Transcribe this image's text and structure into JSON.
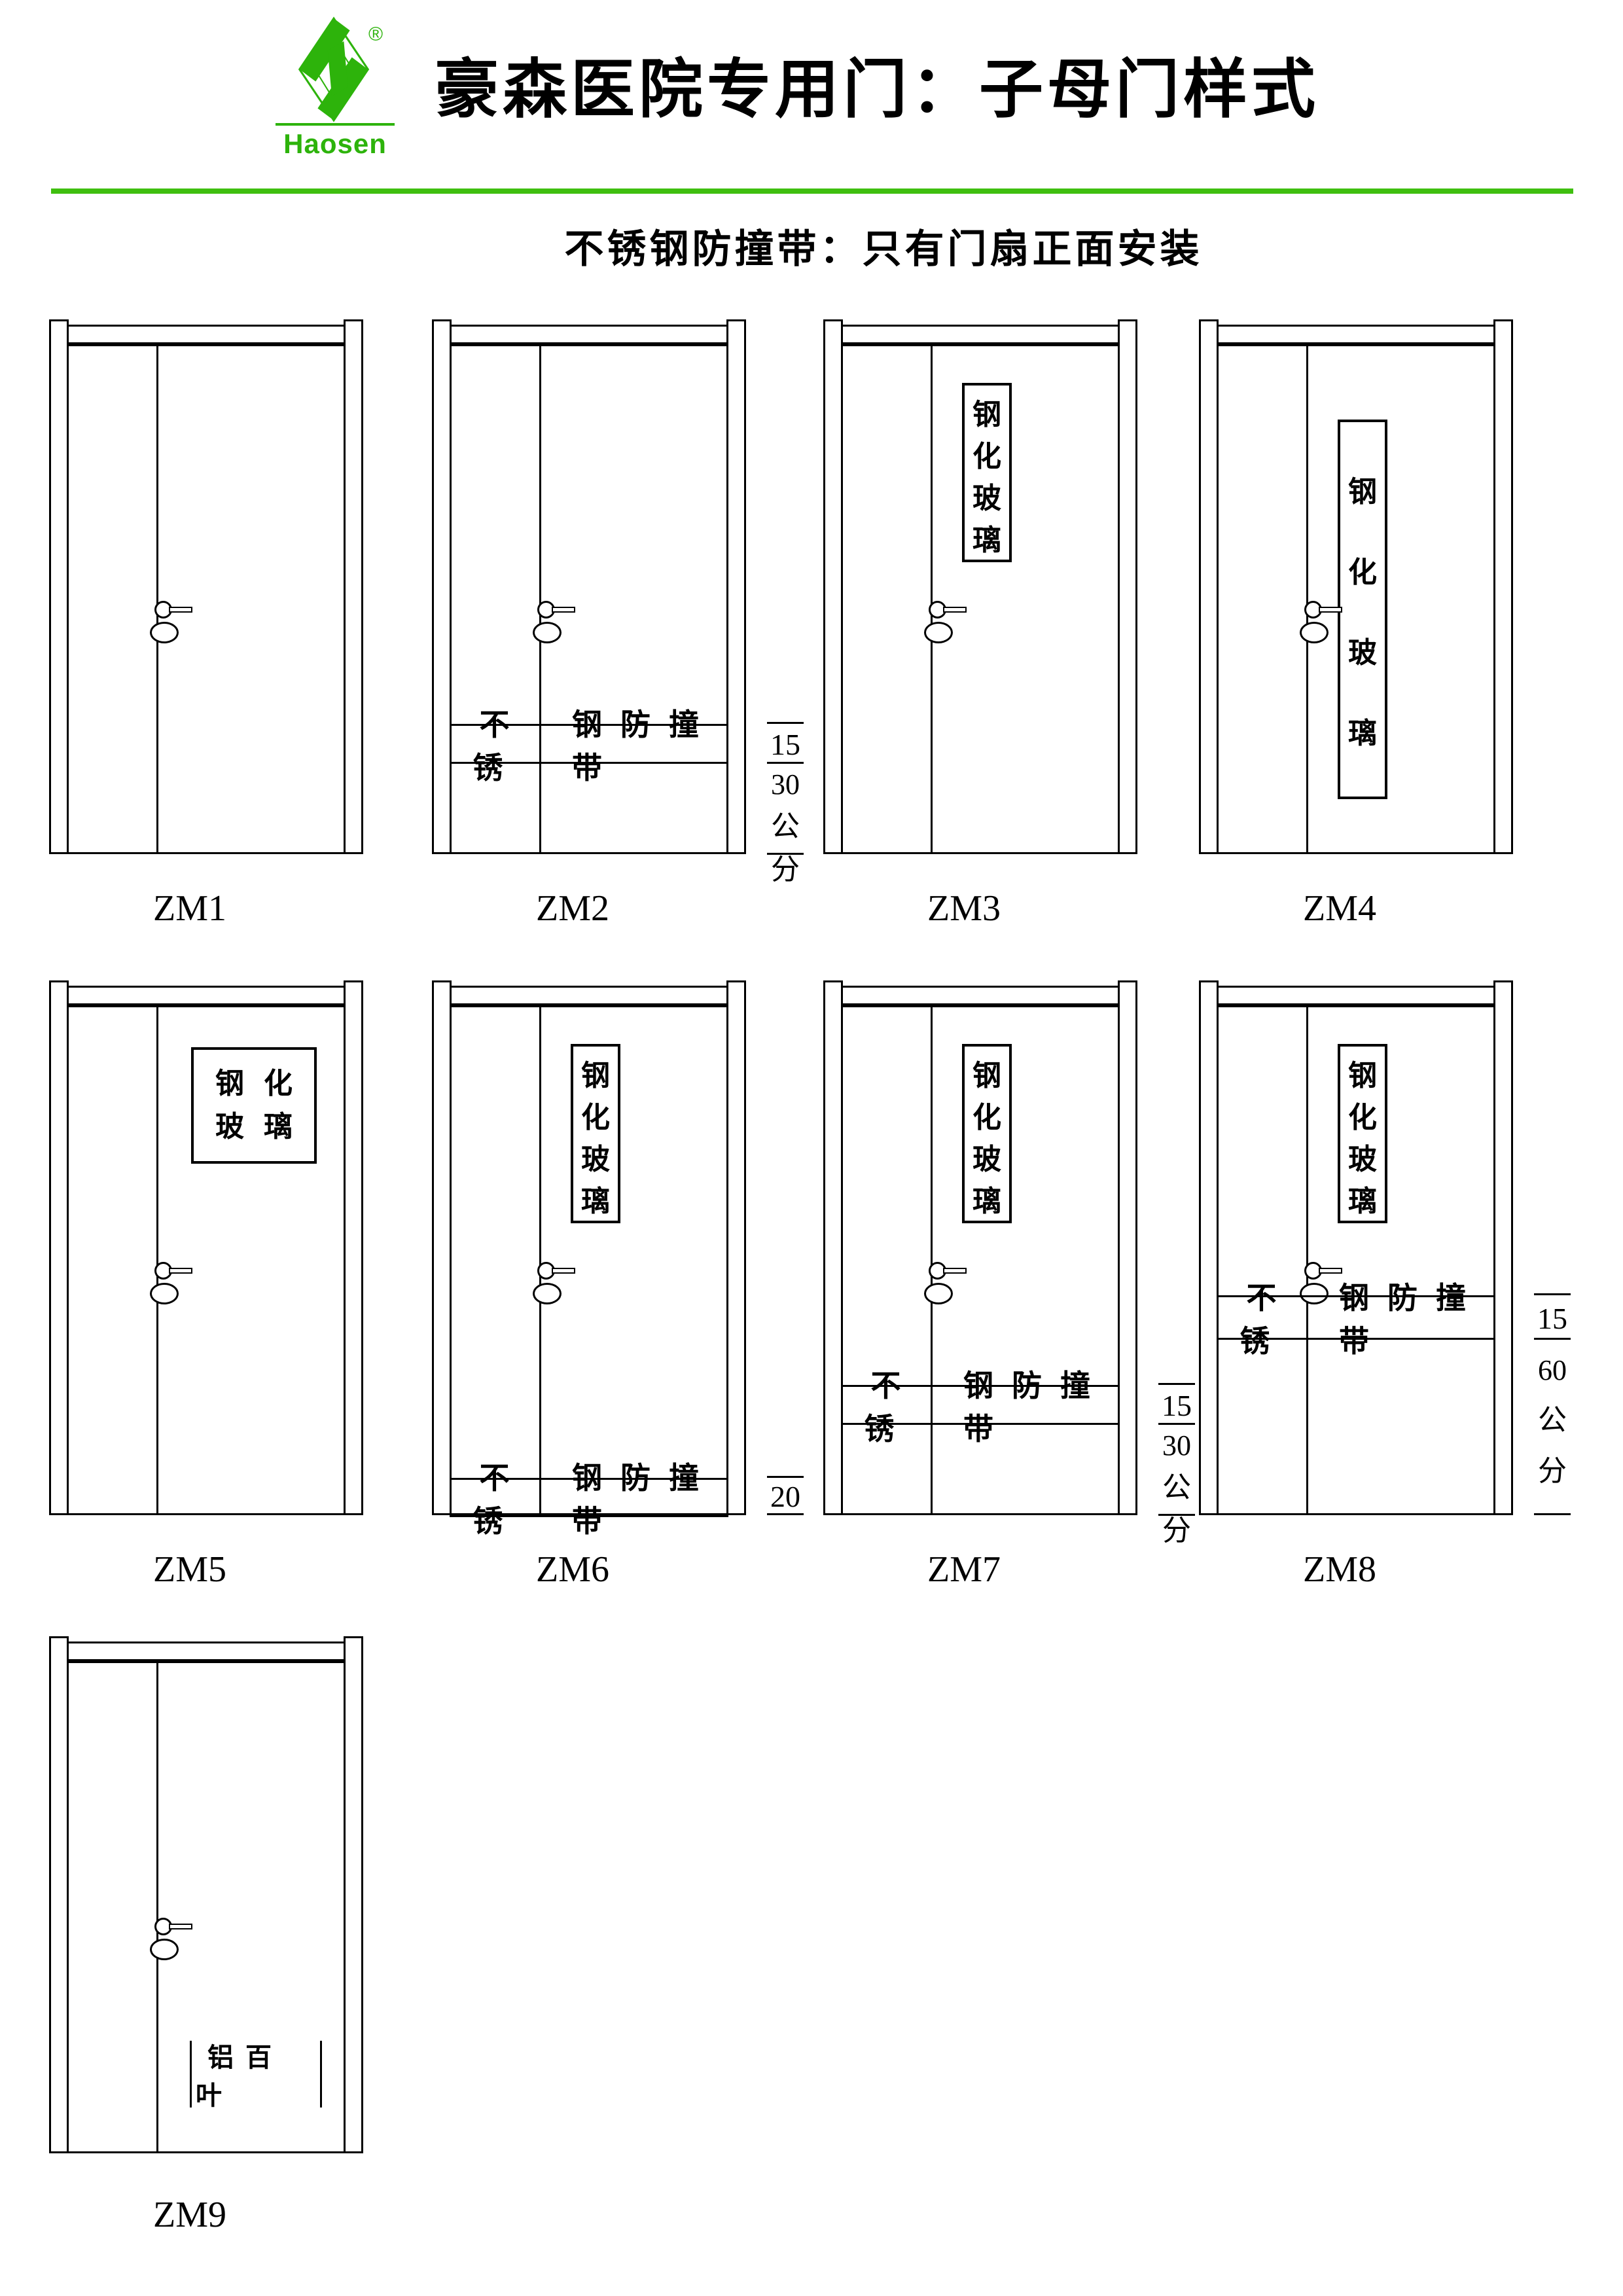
{
  "header": {
    "brand": "Haosen",
    "registered_mark": "®",
    "title": "豪森医院专用门：子母门样式",
    "subtitle": "不锈钢防撞带：只有门扇正面安装",
    "accent_color": "#2db30b"
  },
  "doors": [
    {
      "label": "ZM1"
    },
    {
      "label": "ZM2",
      "strip_left": "不锈",
      "strip_right": "钢防撞带",
      "dim_upper": "15",
      "dim_lower": [
        "30",
        "公",
        "分"
      ]
    },
    {
      "label": "ZM3",
      "glass_text": "钢化玻璃"
    },
    {
      "label": "ZM4",
      "glass_text": "钢化玻璃"
    },
    {
      "label": "ZM5",
      "glass_line1": "钢化",
      "glass_line2": "玻璃"
    },
    {
      "label": "ZM6",
      "glass_text": "钢化玻璃",
      "strip_left": "不锈",
      "strip_right": "钢防撞带",
      "dim_upper": "20"
    },
    {
      "label": "ZM7",
      "glass_text": "钢化玻璃",
      "strip_left": "不锈",
      "strip_right": "钢防撞带",
      "dim_upper": "15",
      "dim_lower": [
        "30",
        "公",
        "分"
      ]
    },
    {
      "label": "ZM8",
      "glass_text": "钢化玻璃",
      "strip_left": "不锈",
      "strip_right": "钢防撞带",
      "dim_upper": "15",
      "dim_lower": [
        "60",
        "公",
        "分"
      ]
    },
    {
      "label": "ZM9",
      "louver_text": "铝百叶"
    }
  ]
}
